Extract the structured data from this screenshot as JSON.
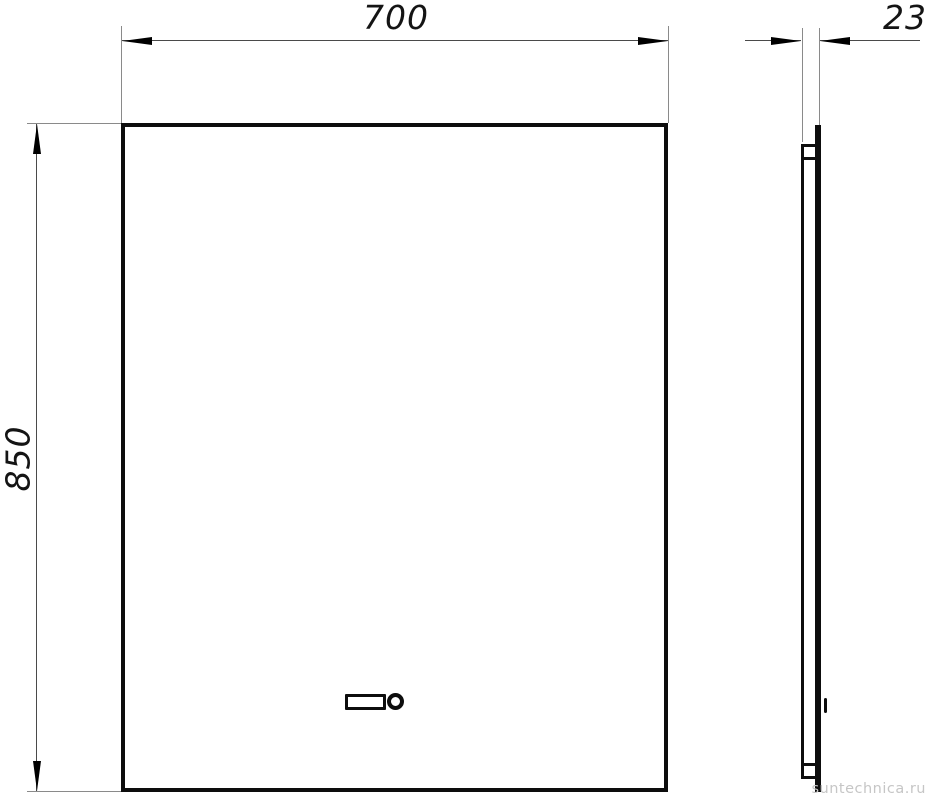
{
  "drawing": {
    "colors": {
      "outline": "#0d0d0d",
      "dimension_line": "#4a4a4a",
      "extension_line": "#8a8a8a",
      "text": "#141414"
    },
    "front_view": {
      "width_label": "700",
      "height_label": "850",
      "sensor": {
        "display_icon": "rounded-rect-display",
        "button_icon": "circle-ring-button"
      }
    },
    "side_view": {
      "depth_label": "23",
      "features": [
        "top-mount-bracket",
        "bottom-mount-bracket",
        "sensor-side-tick"
      ]
    }
  },
  "watermark": {
    "text": "suntechnica.ru",
    "color": "#c6c6c6"
  }
}
